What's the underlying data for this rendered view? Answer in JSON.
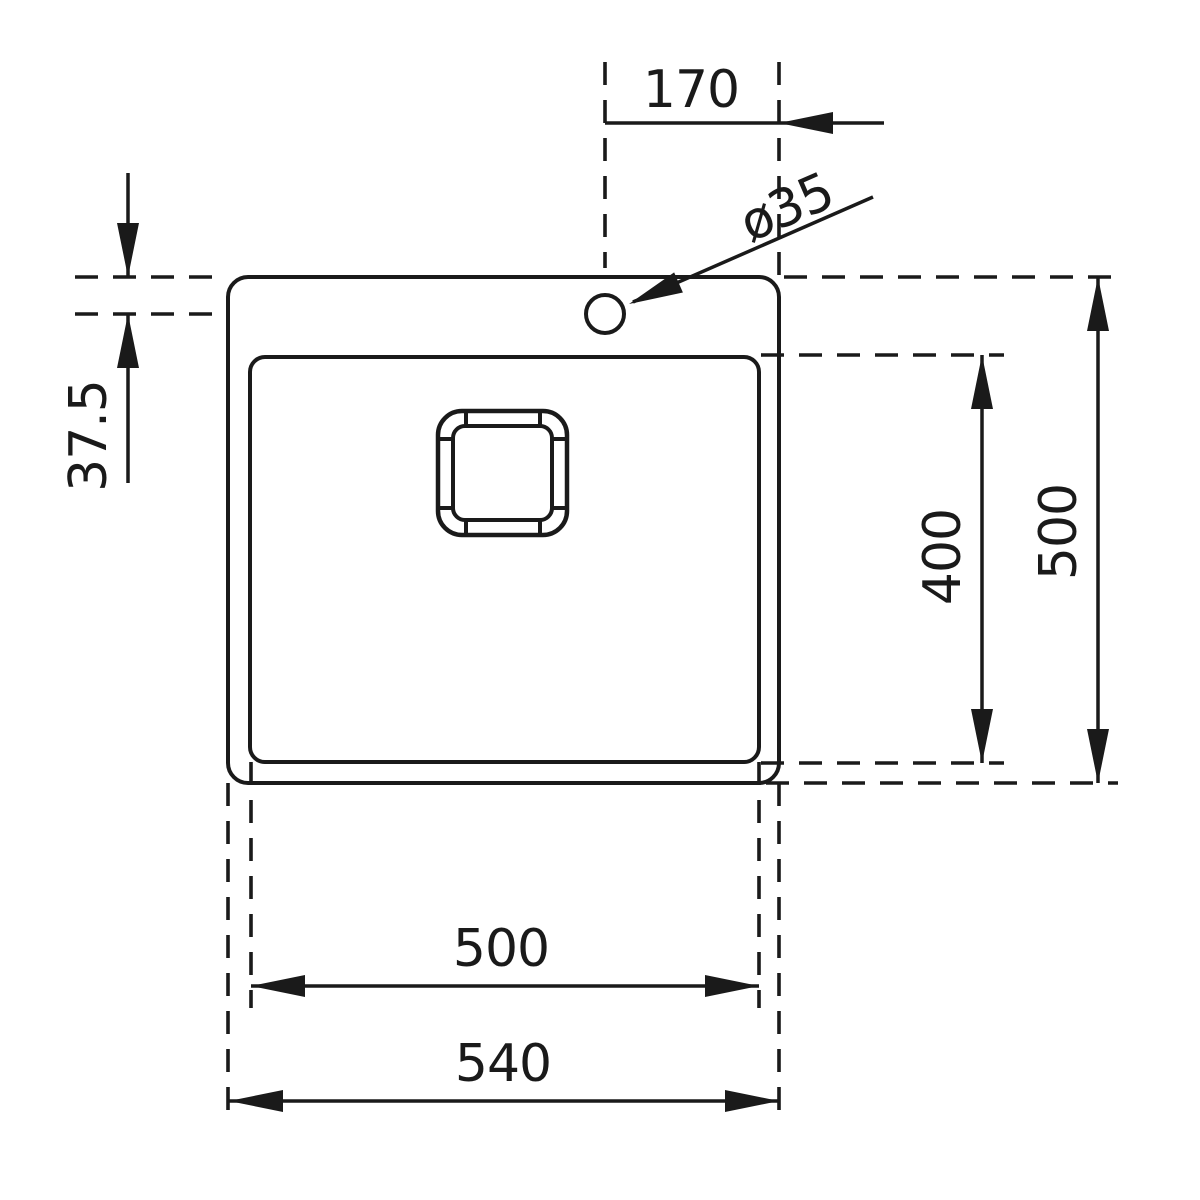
{
  "drawing": {
    "title": "Sink top-view dimension drawing",
    "view": "top"
  },
  "colors": {
    "ink": "#1a1a1a",
    "background": "#ffffff"
  },
  "dimensions": [
    {
      "id": "tap-hole-to-right-edge",
      "label": "170"
    },
    {
      "id": "tap-hole-diameter",
      "label": "ø35"
    },
    {
      "id": "tap-hole-to-top-edge",
      "label": "37.5"
    },
    {
      "id": "bowl-front-to-back",
      "label": "400"
    },
    {
      "id": "overall-front-to-back",
      "label": "500"
    },
    {
      "id": "bowl-width",
      "label": "500"
    },
    {
      "id": "overall-width",
      "label": "540"
    }
  ]
}
